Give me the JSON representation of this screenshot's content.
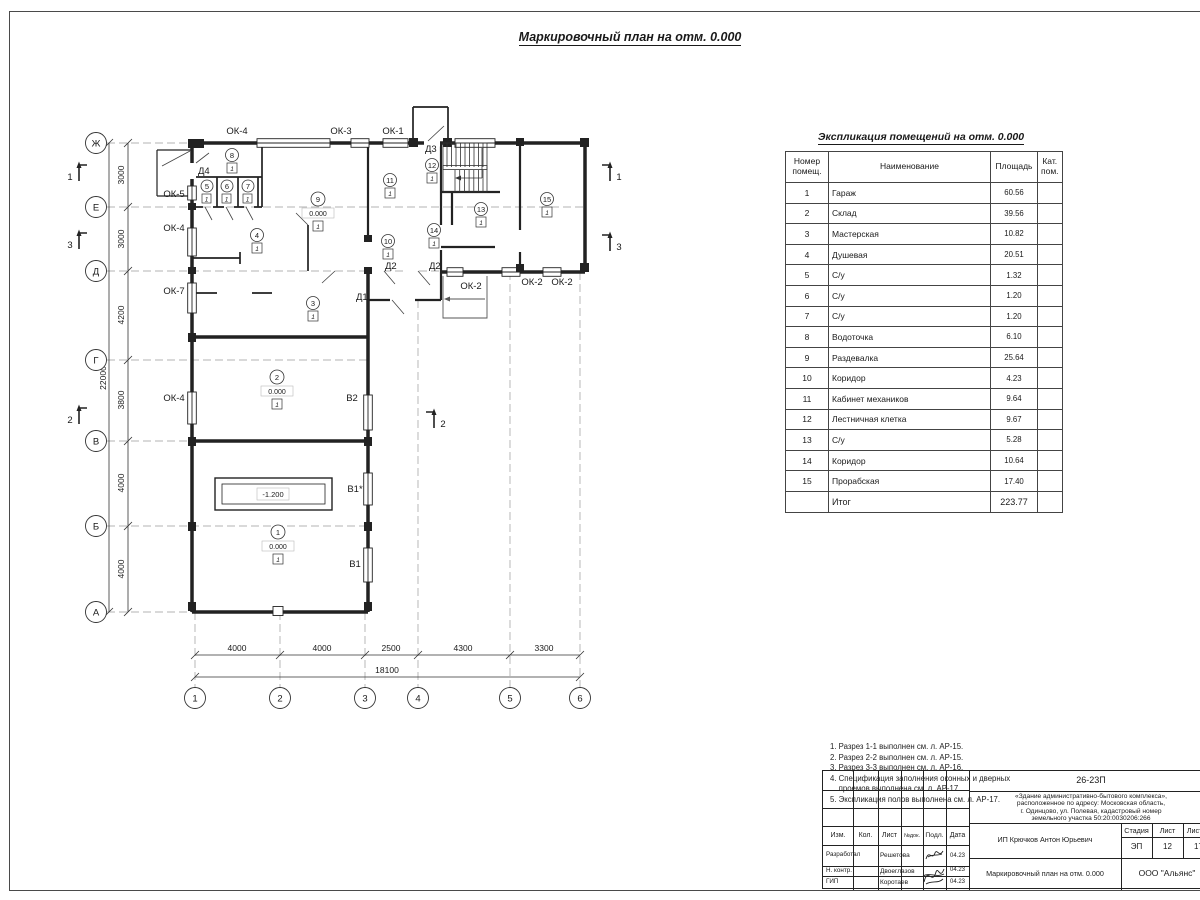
{
  "sheet": {
    "main_title": "Маркировочный план на отм. 0.000"
  },
  "plan": {
    "axes_left": [
      "Ж",
      "Е",
      "Д",
      "Г",
      "В",
      "Б",
      "А"
    ],
    "axes_bottom": [
      "1",
      "2",
      "3",
      "4",
      "5",
      "6"
    ],
    "dims_left": [
      "3000",
      "3000",
      "4200",
      "3800",
      "4000",
      "4000"
    ],
    "total_left": "22000",
    "dims_bottom": [
      "4000",
      "4000",
      "2500",
      "4300",
      "3300"
    ],
    "total_bottom": "18100",
    "sections": {
      "s1": "1",
      "s2": "2",
      "s3": "3"
    },
    "labels": {
      "ok4_top": "ОК-4",
      "ok3": "ОК-3",
      "ok1": "ОК-1",
      "d3": "Д3",
      "d4": "Д4",
      "ok5": "ОК-5",
      "ok4_left1": "ОК-4",
      "ok7": "ОК-7",
      "ok4_left2": "ОК-4",
      "d2_1": "Д2",
      "d2_2": "Д2",
      "d1": "Д1",
      "ok2_1": "ОК-2",
      "ok2_2": "ОК-2",
      "ok2_3": "ОК-2",
      "v2": "В2",
      "v1a": "В1*",
      "v1b": "В1"
    },
    "pit": "-1.200",
    "rooms": [
      {
        "num": "1",
        "elev": "0.000",
        "floor": "1"
      },
      {
        "num": "2",
        "elev": "0.000",
        "floor": "1"
      },
      {
        "num": "3",
        "floor": "1"
      },
      {
        "num": "4",
        "floor": "1"
      },
      {
        "num": "5",
        "floor": "1"
      },
      {
        "num": "6",
        "floor": "1"
      },
      {
        "num": "7",
        "floor": "1"
      },
      {
        "num": "8",
        "floor": "1"
      },
      {
        "num": "9",
        "elev": "0.000",
        "floor": "1"
      },
      {
        "num": "10",
        "floor": "1"
      },
      {
        "num": "11",
        "floor": "1"
      },
      {
        "num": "12",
        "floor": "1"
      },
      {
        "num": "13",
        "floor": "1"
      },
      {
        "num": "14",
        "floor": "1"
      },
      {
        "num": "15",
        "floor": "1"
      }
    ]
  },
  "table": {
    "title": "Экспликация помещений на отм. 0.000",
    "headers": [
      "Номер помещ.",
      "Наименование",
      "Площадь",
      "Кат. пом."
    ],
    "rows": [
      {
        "num": "1",
        "name": "Гараж",
        "area": "60.56",
        "cat": ""
      },
      {
        "num": "2",
        "name": "Склад",
        "area": "39.56",
        "cat": ""
      },
      {
        "num": "3",
        "name": "Мастерская",
        "area": "10.82",
        "cat": ""
      },
      {
        "num": "4",
        "name": "Душевая",
        "area": "20.51",
        "cat": ""
      },
      {
        "num": "5",
        "name": "С/у",
        "area": "1.32",
        "cat": ""
      },
      {
        "num": "6",
        "name": "С/у",
        "area": "1.20",
        "cat": ""
      },
      {
        "num": "7",
        "name": "С/у",
        "area": "1.20",
        "cat": ""
      },
      {
        "num": "8",
        "name": "Водоточка",
        "area": "6.10",
        "cat": ""
      },
      {
        "num": "9",
        "name": "Раздевалка",
        "area": "25.64",
        "cat": ""
      },
      {
        "num": "10",
        "name": "Коридор",
        "area": "4.23",
        "cat": ""
      },
      {
        "num": "11",
        "name": "Кабинет механиков",
        "area": "9.64",
        "cat": ""
      },
      {
        "num": "12",
        "name": "Лестничная клетка",
        "area": "9.67",
        "cat": ""
      },
      {
        "num": "13",
        "name": "С/у",
        "area": "5.28",
        "cat": ""
      },
      {
        "num": "14",
        "name": "Коридор",
        "area": "10.64",
        "cat": ""
      },
      {
        "num": "15",
        "name": "Прорабская",
        "area": "17.40",
        "cat": ""
      }
    ],
    "total_label": "Итог",
    "total_area": "223.77"
  },
  "notes": {
    "lines": [
      "1. Разрез 1-1 выполнен см. л. АР-15.",
      "2. Разрез 2-2 выполнен см. л. АР-15.",
      "3. Разрез 3-3 выполнен см. л. АР-16.",
      "4. Спецификация заполнения оконных и дверных",
      "    проемов выполнена см. л. АР-17.",
      "5. Экспликация полов выполнена см. л. АР-17."
    ]
  },
  "stamp": {
    "code": "26-23П",
    "object_lines": [
      "«Здание административно-бытового комплекса»,",
      "расположенное по адресу: Московская область,",
      "г. Одинцово, ул. Полевая, кадастровый номер",
      "земельного участка 50:20:0030206:266"
    ],
    "cols": {
      "izm": "Изм.",
      "kol": "Кол.",
      "list": "Лист",
      "ndok": "№док.",
      "podp": "Подл.",
      "data": "Дата"
    },
    "sign_rows": [
      {
        "role": "Разработал",
        "name": "Решетова",
        "date": "04.23"
      },
      {
        "role": "Н. контр.",
        "name": "Двоеглазов",
        "date": "04.23"
      },
      {
        "role": "ГИП",
        "name": "Коротаев",
        "date": "04.23"
      }
    ],
    "designer": "ИП Крючков Антон Юрьевич",
    "stage_label": "Стадия",
    "sheet_label": "Лист",
    "sheets_label": "Листов",
    "stage": "ЭП",
    "sheet": "12",
    "sheets": "17",
    "doc_title": "Маркировочный план на отм. 0.000",
    "company": "ООО \"Альянс\""
  }
}
